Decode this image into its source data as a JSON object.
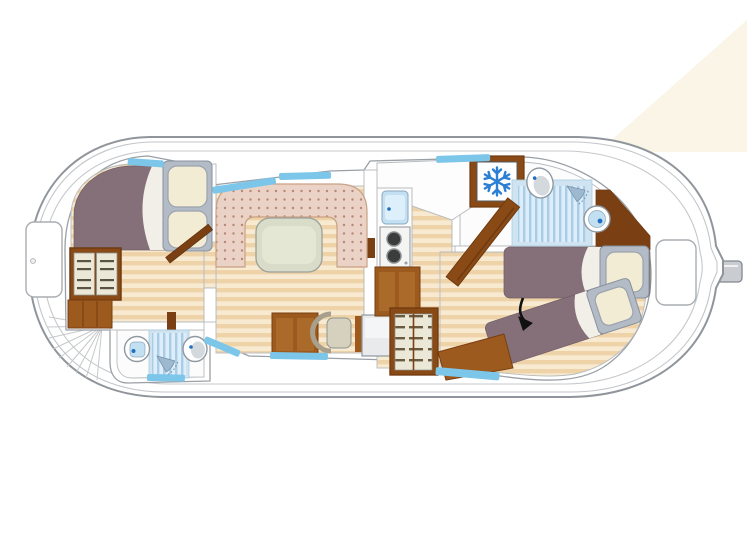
{
  "figure": {
    "type": "boat-floorplan",
    "description": "Top-down deck plan of a canal cruiser: bow cabin with double bed (left), bathroom amidships, central salon with U-shaped dinette and table, galley with sink/stove/fridge, aft bathroom, aft cabin with two single beds (one set diagonally, marked with an arrow), surrounded by an outer walking deck and stern rudder tiller (right)."
  },
  "colors": {
    "hull_stroke": "#8f959b",
    "deck": "#ffffff",
    "wood_dark": "#eed2a8",
    "wood_light": "#f8ead0",
    "bed_purple": "#857079",
    "bed_sheet": "#f1efe7",
    "pillow_cream": "#f3ecd4",
    "pillow_frame": "#b3bbc6",
    "dinette_pink": "#ead2c6",
    "dinette_dot": "#b98875",
    "table_green": "#d9dcc8",
    "table_top": "#e4e7d3",
    "brown": "#9c5a1e",
    "brown_dark": "#7a3f12",
    "brown_door": "#8a4a16",
    "panel_light": "#a96a2a",
    "shelf_cream": "#ece8d8",
    "window_blue": "#7cc6ea",
    "shower_frame": "#cfe3f1",
    "shower_base": "#ddeefa",
    "shower_stripe": "#a9cde6",
    "sink_bowl": "#c2e0f2",
    "water_dot": "#1f6fc0",
    "snowflake_blue": "#2b7fd4",
    "burner_dark": "#3c3c3c",
    "counter_white": "#fdfdfd",
    "desk_gray": "#e8eaec",
    "chair_seat": "#d6d0bf",
    "arrow_black": "#111111",
    "light_beam": "#f9f3e2",
    "rudder_gray": "#c9cdd1"
  },
  "areas": {
    "bow_cabin": {
      "furniture": [
        "double-bed",
        "headboard-with-two-pillows",
        "open-shelf-wardrobe",
        "low-cabinet",
        "open-door"
      ]
    },
    "mid_bathroom": {
      "fixtures": [
        "washbasin",
        "shower",
        "toilet"
      ]
    },
    "salon": {
      "furniture": [
        "u-shaped-dinette",
        "oval-table",
        "sideboard-cabinet",
        "desk-chair",
        "desk"
      ]
    },
    "galley": {
      "fixtures": [
        "sink",
        "two-burner-stove",
        "base-cabinets",
        "fridge-freezer-with-snowflake"
      ]
    },
    "aft_bathroom": {
      "fixtures": [
        "toilet",
        "shower",
        "shower-head",
        "washbasin"
      ]
    },
    "aft_cabin": {
      "furniture": [
        "single-bed",
        "diagonal-single-bed",
        "bench",
        "shelved-wardrobe"
      ],
      "annotation": "black-arrow-pointing-to-diagonal-bed"
    },
    "deck": {
      "features": [
        "bow-hatch",
        "stern-hatch",
        "rudder-tiller",
        "radiating-steps"
      ]
    }
  }
}
